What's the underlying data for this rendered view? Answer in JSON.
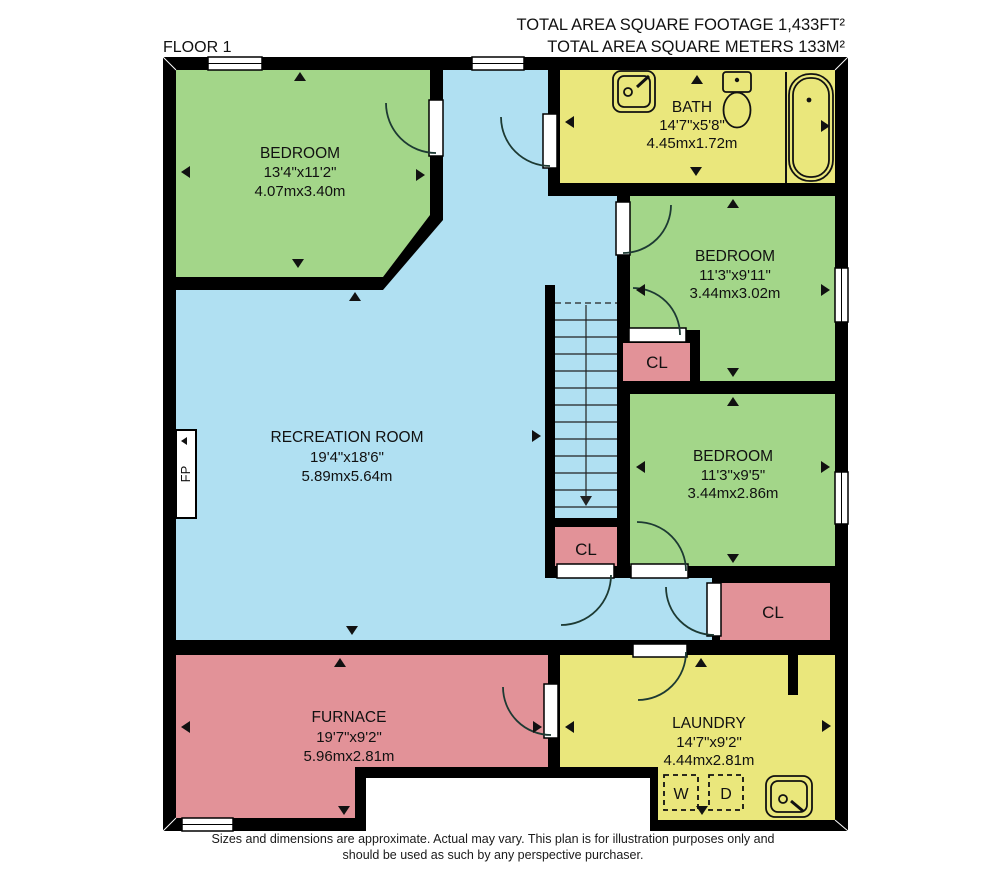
{
  "header": {
    "total_area_ft": "TOTAL AREA SQUARE FOOTAGE 1,433FT²",
    "total_area_m": "TOTAL AREA SQUARE METERS 133M²"
  },
  "floor_label": "FLOOR 1",
  "rooms": [
    {
      "name": "BEDROOM",
      "imperial": "13'4\"x11'2\"",
      "metric": "4.07mx3.40m"
    },
    {
      "name": "BATH",
      "imperial": "14'7\"x5'8\"",
      "metric": "4.45mx1.72m"
    },
    {
      "name": "BEDROOM",
      "imperial": "11'3\"x9'11\"",
      "metric": "3.44mx3.02m"
    },
    {
      "name": "BEDROOM",
      "imperial": "11'3\"x9'5\"",
      "metric": "3.44mx2.86m"
    },
    {
      "name": "RECREATION ROOM",
      "imperial": "19'4\"x18'6\"",
      "metric": "5.89mx5.64m"
    },
    {
      "name": "FURNACE",
      "imperial": "19'7\"x9'2\"",
      "metric": "5.96mx2.81m"
    },
    {
      "name": "LAUNDRY",
      "imperial": "14'7\"x9'2\"",
      "metric": "4.44mx2.81m"
    }
  ],
  "closet_label": "CL",
  "fireplace_label": "FP",
  "washer_label": "W",
  "dryer_label": "D",
  "disclaimer": {
    "line1": "Sizes and dimensions are approximate. Actual may vary. This plan is for illustration purposes only and",
    "line2": "should be used as such by any perspective purchaser."
  },
  "colors": {
    "wall": "#000000",
    "bedroom": "#a3d689",
    "bath": "#eae77c",
    "recreation": "#b0e0f2",
    "closet": "#e29298",
    "text": "#111111"
  }
}
